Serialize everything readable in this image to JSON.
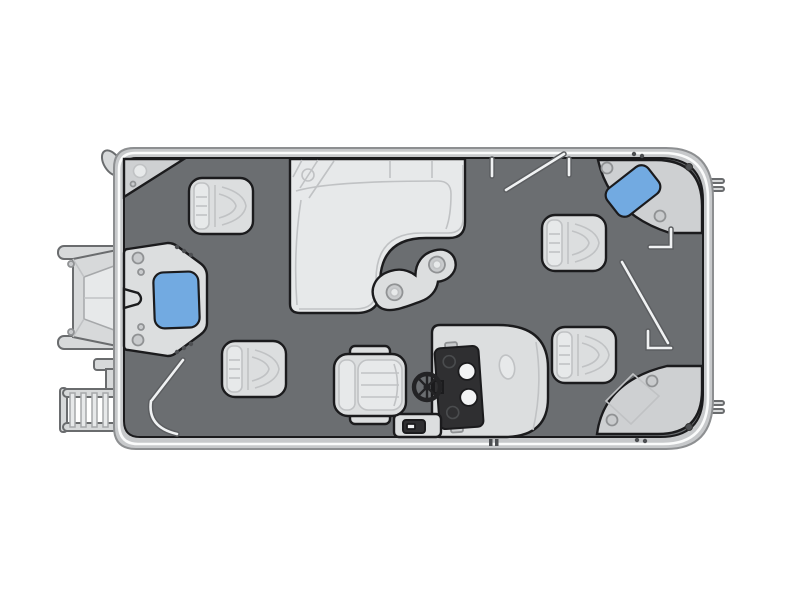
{
  "diagram": {
    "type": "pontoon-boat-floorplan",
    "view": "top-down",
    "orientation": {
      "bow": "right",
      "stern": "left"
    },
    "description": "Stylized overhead floor plan of a pontoon boat on a white background: gray deck, light-gray furniture, two blue pads, exterior outboard motor and boarding ladder at the stern."
  },
  "palette": {
    "background": "#ffffff",
    "hull_band": "#c7c9cb",
    "hull_edge": "#8d8f91",
    "hull_stripe": "#fafbfb",
    "deck": "#6b6e71",
    "outline": "#1b1b1d",
    "furniture": "#dcdedf",
    "furniture_light": "#e7e9ea",
    "platform": "#ced0d2",
    "detail_line": "#c0c2c4",
    "dashboard": "#2f2f31",
    "gauge_white": "#f2f3f4",
    "blue_pad": "#72aae1",
    "rail_light": "#f0f2f3",
    "rail_dark": "#5b5d60",
    "rivet": "#4d4f52",
    "exterior_metal": "#d7d9da",
    "exterior_edge": "#6a6c6e",
    "wheel": "#232325"
  },
  "components": [
    {
      "name": "hull",
      "label": "Pontoon hull with rub-rail band"
    },
    {
      "name": "deck",
      "label": "Main deck"
    },
    {
      "name": "outboard-motor",
      "label": "Outboard motor (exterior, stern center)"
    },
    {
      "name": "boarding-ladder",
      "label": "Boarding ladder (exterior, stern corner)"
    },
    {
      "name": "stern-gate-module",
      "label": "Stern entry gate platform with blue pad",
      "blue_pad": true
    },
    {
      "name": "corner-step-platform",
      "label": "Triangular corner step with cup holder (top-left)"
    },
    {
      "name": "fishing-chair",
      "label": "Pedestal fishing chair",
      "count": 4
    },
    {
      "name": "l-lounge",
      "label": "L-shaped lounge seat (top center)"
    },
    {
      "name": "kidney-table",
      "label": "Kidney-shaped table with two cup holders"
    },
    {
      "name": "captain-chair",
      "label": "Captain's helm chair"
    },
    {
      "name": "steering-wheel",
      "label": "Steering wheel"
    },
    {
      "name": "helm-console",
      "label": "Helm console with gauges and glove box"
    },
    {
      "name": "console-step",
      "label": "Storage step at console base"
    },
    {
      "name": "bow-corner-platform-top",
      "label": "Bow corner platform with blue pad (top-right)",
      "blue_pad": true
    },
    {
      "name": "bow-corner-platform-bottom",
      "label": "Bow corner platform (bottom-right)"
    },
    {
      "name": "gate-rails",
      "label": "Fence gate posts and open gate rails"
    },
    {
      "name": "cleats",
      "label": "Mooring cleats on bow side"
    }
  ],
  "counts": {
    "chairs": 4,
    "blue_pads": 2,
    "tables": 1,
    "lounges": 1
  }
}
